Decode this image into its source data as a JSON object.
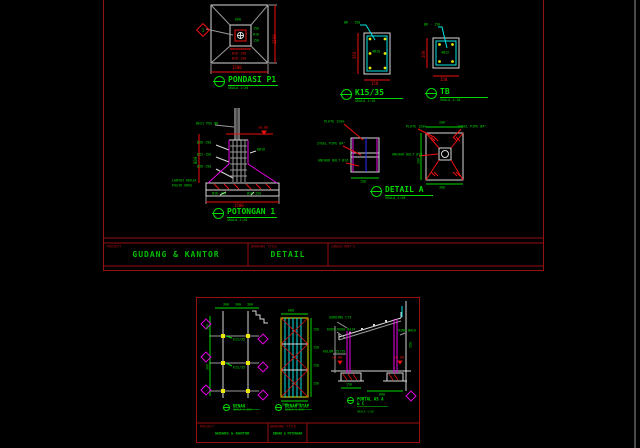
{
  "ts": {
    "marker": "1",
    "pondasi": {
      "title": "PONDASI P1",
      "scale": "SKALA 1:20",
      "dim_right": "1500",
      "dim_bottom": "1500",
      "n_top": "600",
      "n_r1": "150",
      "n_r2": "Ø16",
      "n_r3": "150",
      "n_c1": "Ø16-150",
      "n_c2": "Ø16-150"
    },
    "k15": {
      "title": "K15/35",
      "scale": "SKALA 1:10",
      "top": "Ø8 - 150",
      "bars": "4Ø10",
      "dim_left": "350",
      "dim_bottom": "150"
    },
    "tb": {
      "title": "TB",
      "scale": "SKALA 1:10",
      "top": "Ø8 - 150",
      "bars": "4Ø12",
      "dim_left": "200",
      "dim_bottom": "150"
    },
    "pot": {
      "title": "POTONGAN 1",
      "scale": "SKALA 1:20",
      "n_top": "BESI POS Ø6",
      "elev": "±0.00",
      "l1": "Ø16-150",
      "l2": "Ø12-150",
      "l3": "Ø16-150",
      "r1": "8Ø16",
      "b1": "Ø16-150",
      "b2": "Ø16-150",
      "side1": "LANTAI KERJA",
      "side2": "PASIR URUG",
      "dim_left": "800",
      "dim_bottom": "1500"
    },
    "det": {
      "title": "DETAIL A",
      "scale": "SKALA 1:20",
      "lv1": "PLATE 12mm",
      "lv2": "STEEL PIPE Ø4\"",
      "lv3": "ANCHOR BOLT Ø16",
      "lv_dim": "150",
      "rv1": "PLATE 12mm",
      "rv2": "STEEL PIPE Ø4\"",
      "rv3": "ANCHOR BOLT Ø16",
      "rv_top": "200",
      "rv_bottom": "300",
      "rv_left": "200"
    },
    "block": {
      "project_label": "PROJECT",
      "project": "GUDANG  &  KANTOR",
      "title_label": "DRAWING TITLE",
      "title": "DETAIL",
      "right_label": "CONSULTANT'S"
    }
  },
  "bs": {
    "denah": {
      "title": "DENAH",
      "scale": "SKALA 1:100",
      "d1": "300",
      "d2": "300",
      "d3": "300",
      "v1": "300",
      "v2": "300",
      "k1": "K15/35",
      "k2": "K15/35"
    },
    "atap": {
      "title": "DENAH ATAP",
      "scale": "SKALA 1:100",
      "t1": "600",
      "r1": "150",
      "r2": "150",
      "r3": "150",
      "r4": "150",
      "b1": "300",
      "b2": "300"
    },
    "portal": {
      "title": "PORTAL AS A & C",
      "scale": "SKALA 1:50",
      "n1": "GORDING C75",
      "n2": "KUDA-KUDA BAJA",
      "n3": "KOLOM 15/35",
      "n4": "RING BALK",
      "e1": "±0.00",
      "e2": "±0.00",
      "d1": "150",
      "d2": "600",
      "dv": "350"
    },
    "block": {
      "project_label": "PROJECT",
      "project": "GUDANG & KANTOR",
      "title_label": "DRAWING TITLE",
      "title": "DENAH & POTONGAN"
    }
  }
}
